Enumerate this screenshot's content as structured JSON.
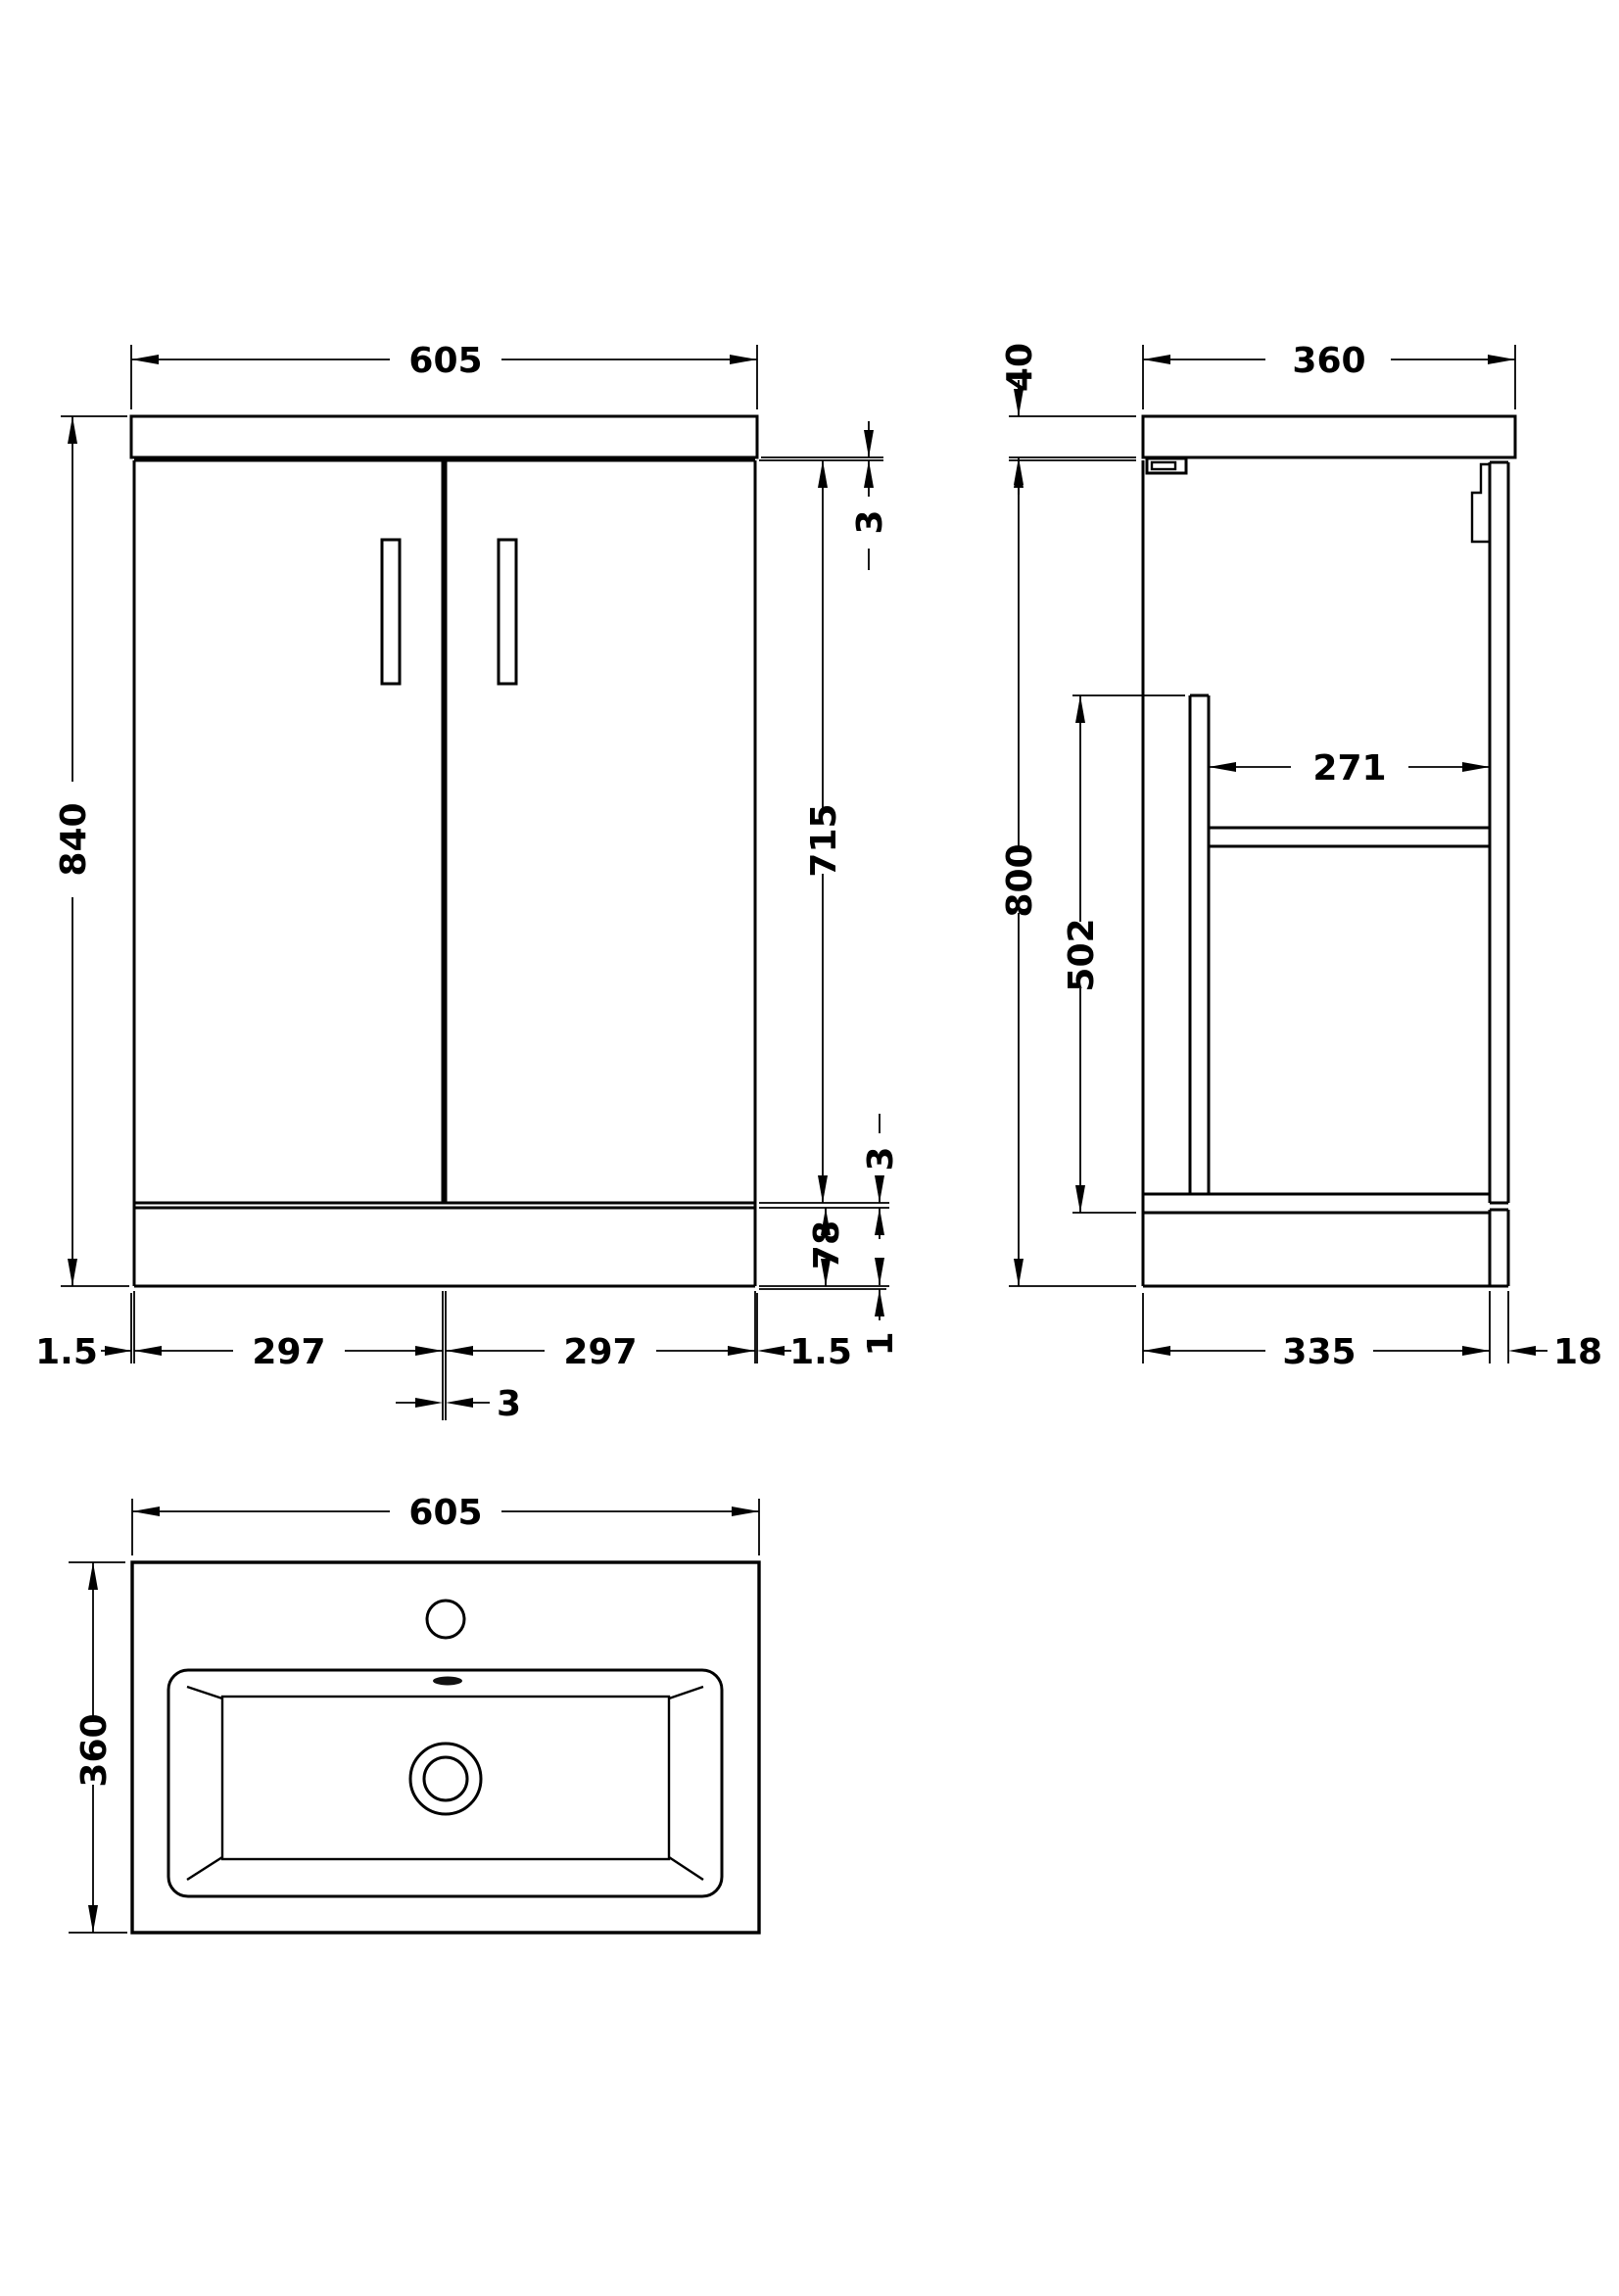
{
  "front_view": {
    "width": "605",
    "overall_height": "840",
    "worktop_door_gap": "3",
    "door_height": "715",
    "door_plinth_gap": "3",
    "plinth_height": "78",
    "floor_gap": "1",
    "left_overhang": "1.5",
    "left_door_width": "297",
    "right_door_width": "297",
    "right_overhang": "1.5",
    "door_center_gap": "3"
  },
  "side_view": {
    "worktop_thickness": "40",
    "depth": "360",
    "shelf_depth": "271",
    "interior_height": "502",
    "cabinet_height": "800",
    "cabinet_depth": "335",
    "door_thickness": "18"
  },
  "basin_view": {
    "width": "605",
    "depth": "360"
  },
  "colors": {
    "line": "#000000",
    "background": "#ffffff"
  }
}
